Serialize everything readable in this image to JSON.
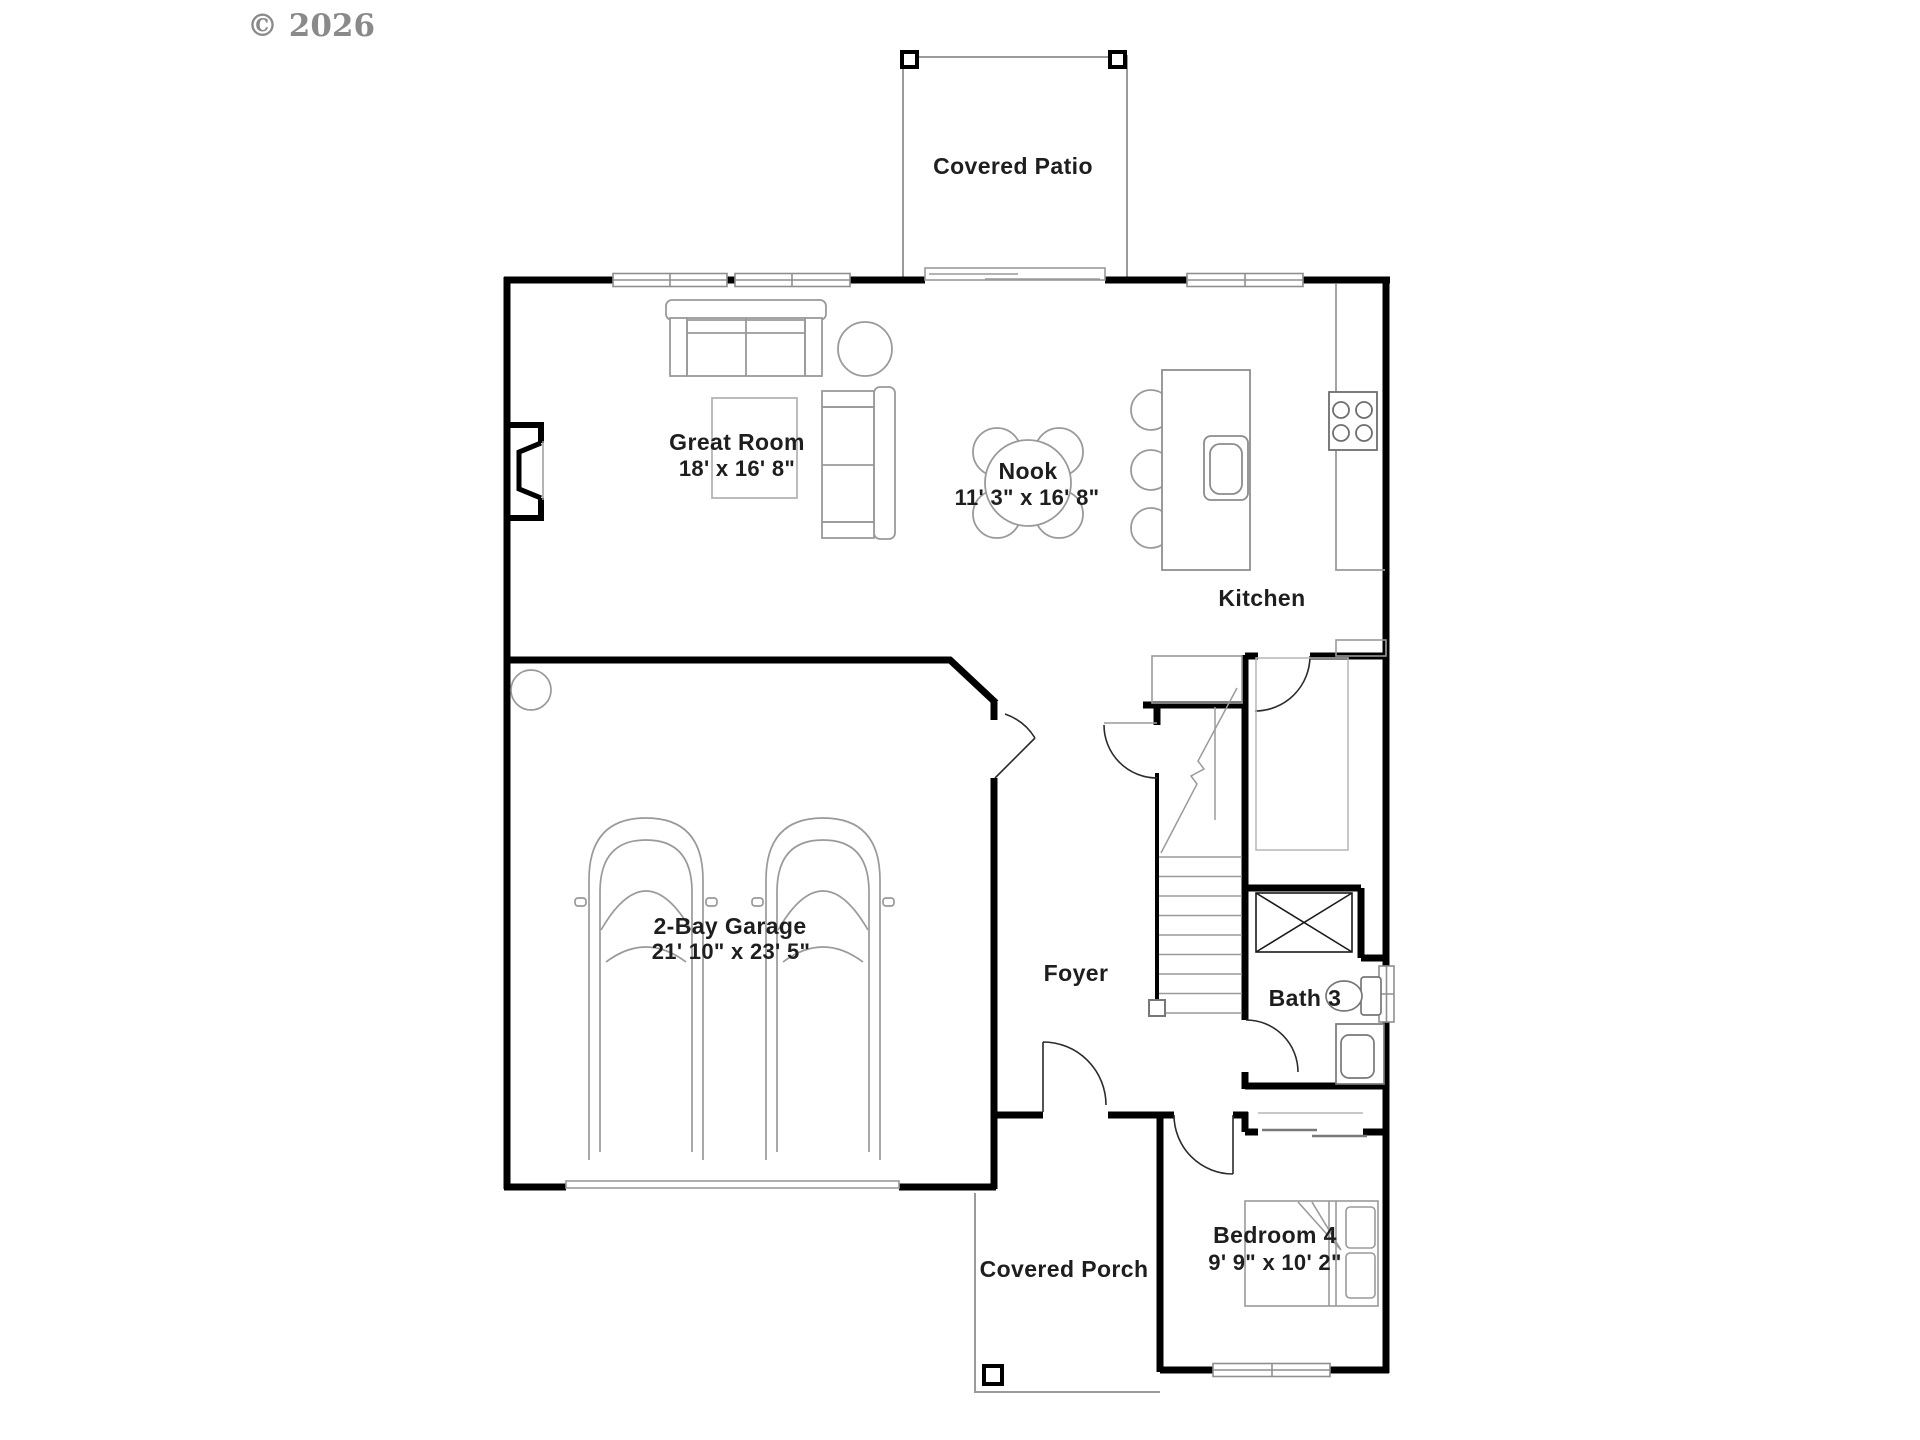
{
  "watermark": "© 2026",
  "colors": {
    "wall": "#000000",
    "fixture_line": "#8c8c8c",
    "light_line": "#a8a8a8",
    "label_text": "#1e1e1e",
    "watermark_text": "#8a8a8a"
  },
  "rooms": {
    "covered_patio": {
      "label": "Covered Patio"
    },
    "great_room": {
      "label": "Great Room",
      "dims": "18' x 16' 8\""
    },
    "nook": {
      "label": "Nook",
      "dims": "11' 3\" x 16' 8\""
    },
    "kitchen": {
      "label": "Kitchen"
    },
    "garage": {
      "label": "2-Bay Garage",
      "dims": "21' 10\" x 23' 5\""
    },
    "foyer": {
      "label": "Foyer"
    },
    "bath_3": {
      "label": "Bath 3"
    },
    "bedroom_4": {
      "label": "Bedroom 4",
      "dims": "9' 9\" x 10' 2\""
    },
    "covered_porch": {
      "label": "Covered Porch"
    }
  }
}
